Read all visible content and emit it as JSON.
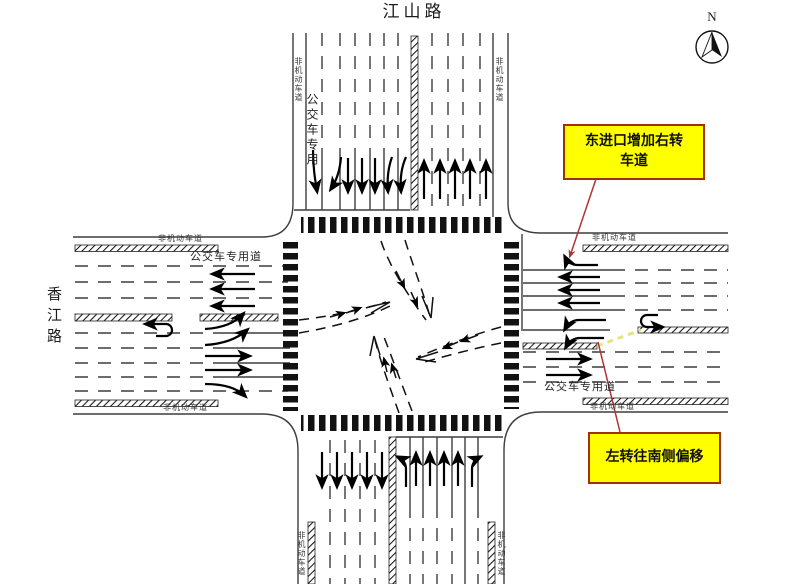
{
  "roads": {
    "north_name": "江山路",
    "west_name": "香江路"
  },
  "compass_label": "N",
  "labels": {
    "non_motorized": "非机动车道",
    "bus_only": "公交车专用",
    "bus_lane": "公交车专用道"
  },
  "callouts": {
    "c1_line1": "东进口增加右转",
    "c1_line2": "车道",
    "c2": "左转往南侧偏移"
  },
  "colors": {
    "callout_bg": "#ffff00",
    "callout_border": "#a33000",
    "leader_line": "#b03434",
    "offset_marking": "#e4e480",
    "road_line": "#3d3d3d",
    "arrow": "#000000"
  }
}
